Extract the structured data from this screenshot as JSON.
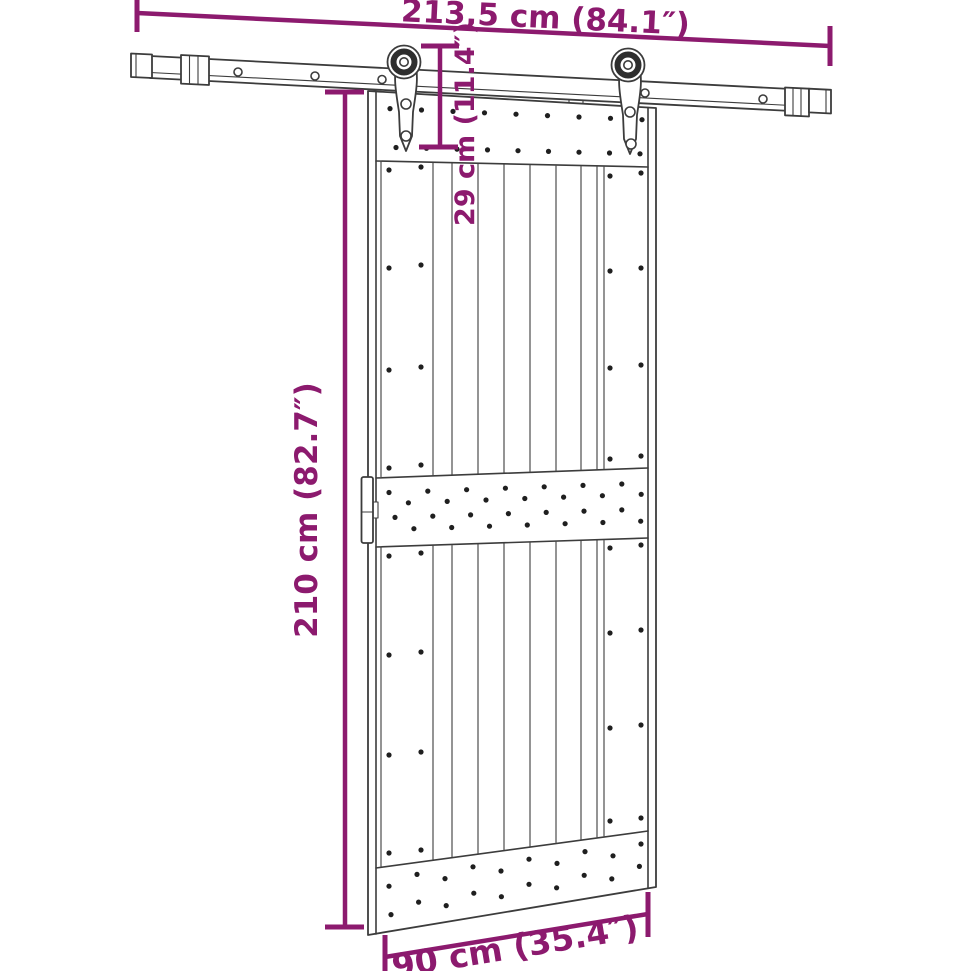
{
  "diagram": {
    "dimensions": {
      "rail_length": "213,5 cm (84.1″)",
      "drop_height": "29 cm (11.4″)",
      "door_height": "210 cm (82.7″)",
      "door_width": "90 cm (35.4″)"
    },
    "colors": {
      "dimension": "#8C1A6E",
      "line_art": "#3C3C3C",
      "background": "#FFFFFF"
    }
  }
}
